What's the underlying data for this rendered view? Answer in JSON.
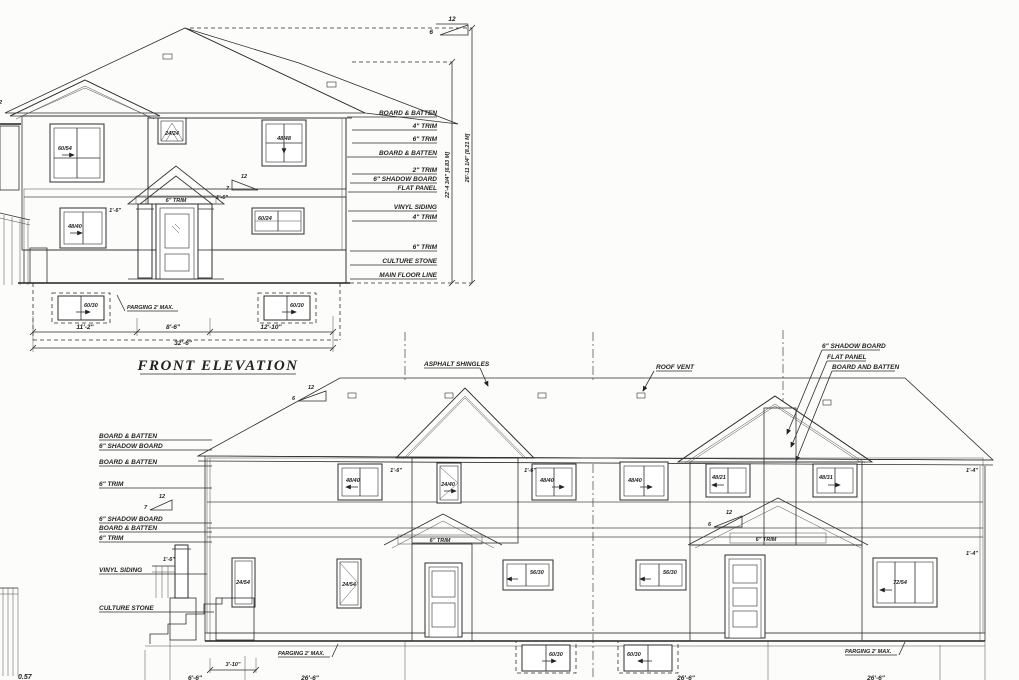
{
  "front": {
    "title": "FRONT ELEVATION",
    "pitch_main": {
      "run": "12",
      "rise": "6"
    },
    "pitch_porch": {
      "run": "12",
      "rise": "7"
    },
    "edge_pitch": "12",
    "porch_trim": "6\" TRIM",
    "dim_porch_left": "1'-6\"",
    "dim_porch_right": "1'-6\"",
    "windows": {
      "gable": "60/54",
      "attic": "24/24",
      "upper_right": "48/48",
      "main_left": "48/40",
      "main_right": "60/24",
      "basement_left": "60/30",
      "basement_right": "60/30"
    },
    "parging": "PARGING 2' MAX.",
    "right_labels": [
      "BOARD & BATTEN",
      "4\" TRIM",
      "6\" TRIM",
      "BOARD & BATTEN",
      "2\" TRIM",
      "6\" SHADOW BOARD",
      "FLAT PANEL",
      "VINYL SIDING",
      "4\" TRIM",
      "6\" TRIM",
      "CULTURE STONE",
      "MAIN FLOOR LINE"
    ],
    "vdim_inner": "22'-4 3/4\" [6.83 M]",
    "vdim_outer": "26'-11 1/4\" [8.21 M]",
    "bottom_dims": [
      "11'-2\"",
      "8'-6\"",
      "12'-10\""
    ],
    "bottom_total": "32'-6\""
  },
  "rear": {
    "label_shingles": "ASPHALT SHINGLES",
    "label_roof_vent": "ROOF VENT",
    "top_right_labels": [
      "6\" SHADOW BOARD",
      "FLAT PANEL",
      "BOARD AND BATTEN"
    ],
    "left_labels": [
      "BOARD & BATTEN",
      "6\" SHADOW BOARD",
      "BOARD & BATTEN",
      "6\" TRIM",
      "6\" SHADOW BOARD",
      "BOARD & BATTEN",
      "6\" TRIM",
      "VINYL SIDING",
      "CULTURE STONE"
    ],
    "pitch_left": {
      "run": "12",
      "rise": "6"
    },
    "pitch_mid": {
      "run": "12",
      "rise": "7"
    },
    "pitch_right": {
      "run": "12",
      "rise": "6"
    },
    "gable1_trim": "6\" TRIM",
    "gable2_trim": "6\" TRIM",
    "windows": {
      "upper_left": "48/40",
      "dormer": "24/40",
      "upper_mid": "48/40",
      "upper_right": "48/40",
      "gable_left": "48/21",
      "gable_right": "48/31",
      "main_1": "24/54",
      "main_2": "24/54",
      "main_3": "56/30",
      "main_4": "56/30",
      "main_5": "72/54",
      "basement_1": "60/30",
      "basement_2": "60/30"
    },
    "parging_left": "PARGING 2' MAX.",
    "parging_right": "PARGING 2' MAX.",
    "dim_porch": "1'-6\"",
    "dim_g1_left": "1'-6\"",
    "dim_g1_right": "1'-6\"",
    "dim_right_top": "1'-4\"",
    "dim_right_wall": "1'-4\"",
    "dim_steps": "3'-10\"",
    "bottom_dims": [
      "6'-6\"",
      "26'-6\"",
      "26'-6\"",
      "26'-6\""
    ],
    "corner_fragment": "0.57"
  }
}
